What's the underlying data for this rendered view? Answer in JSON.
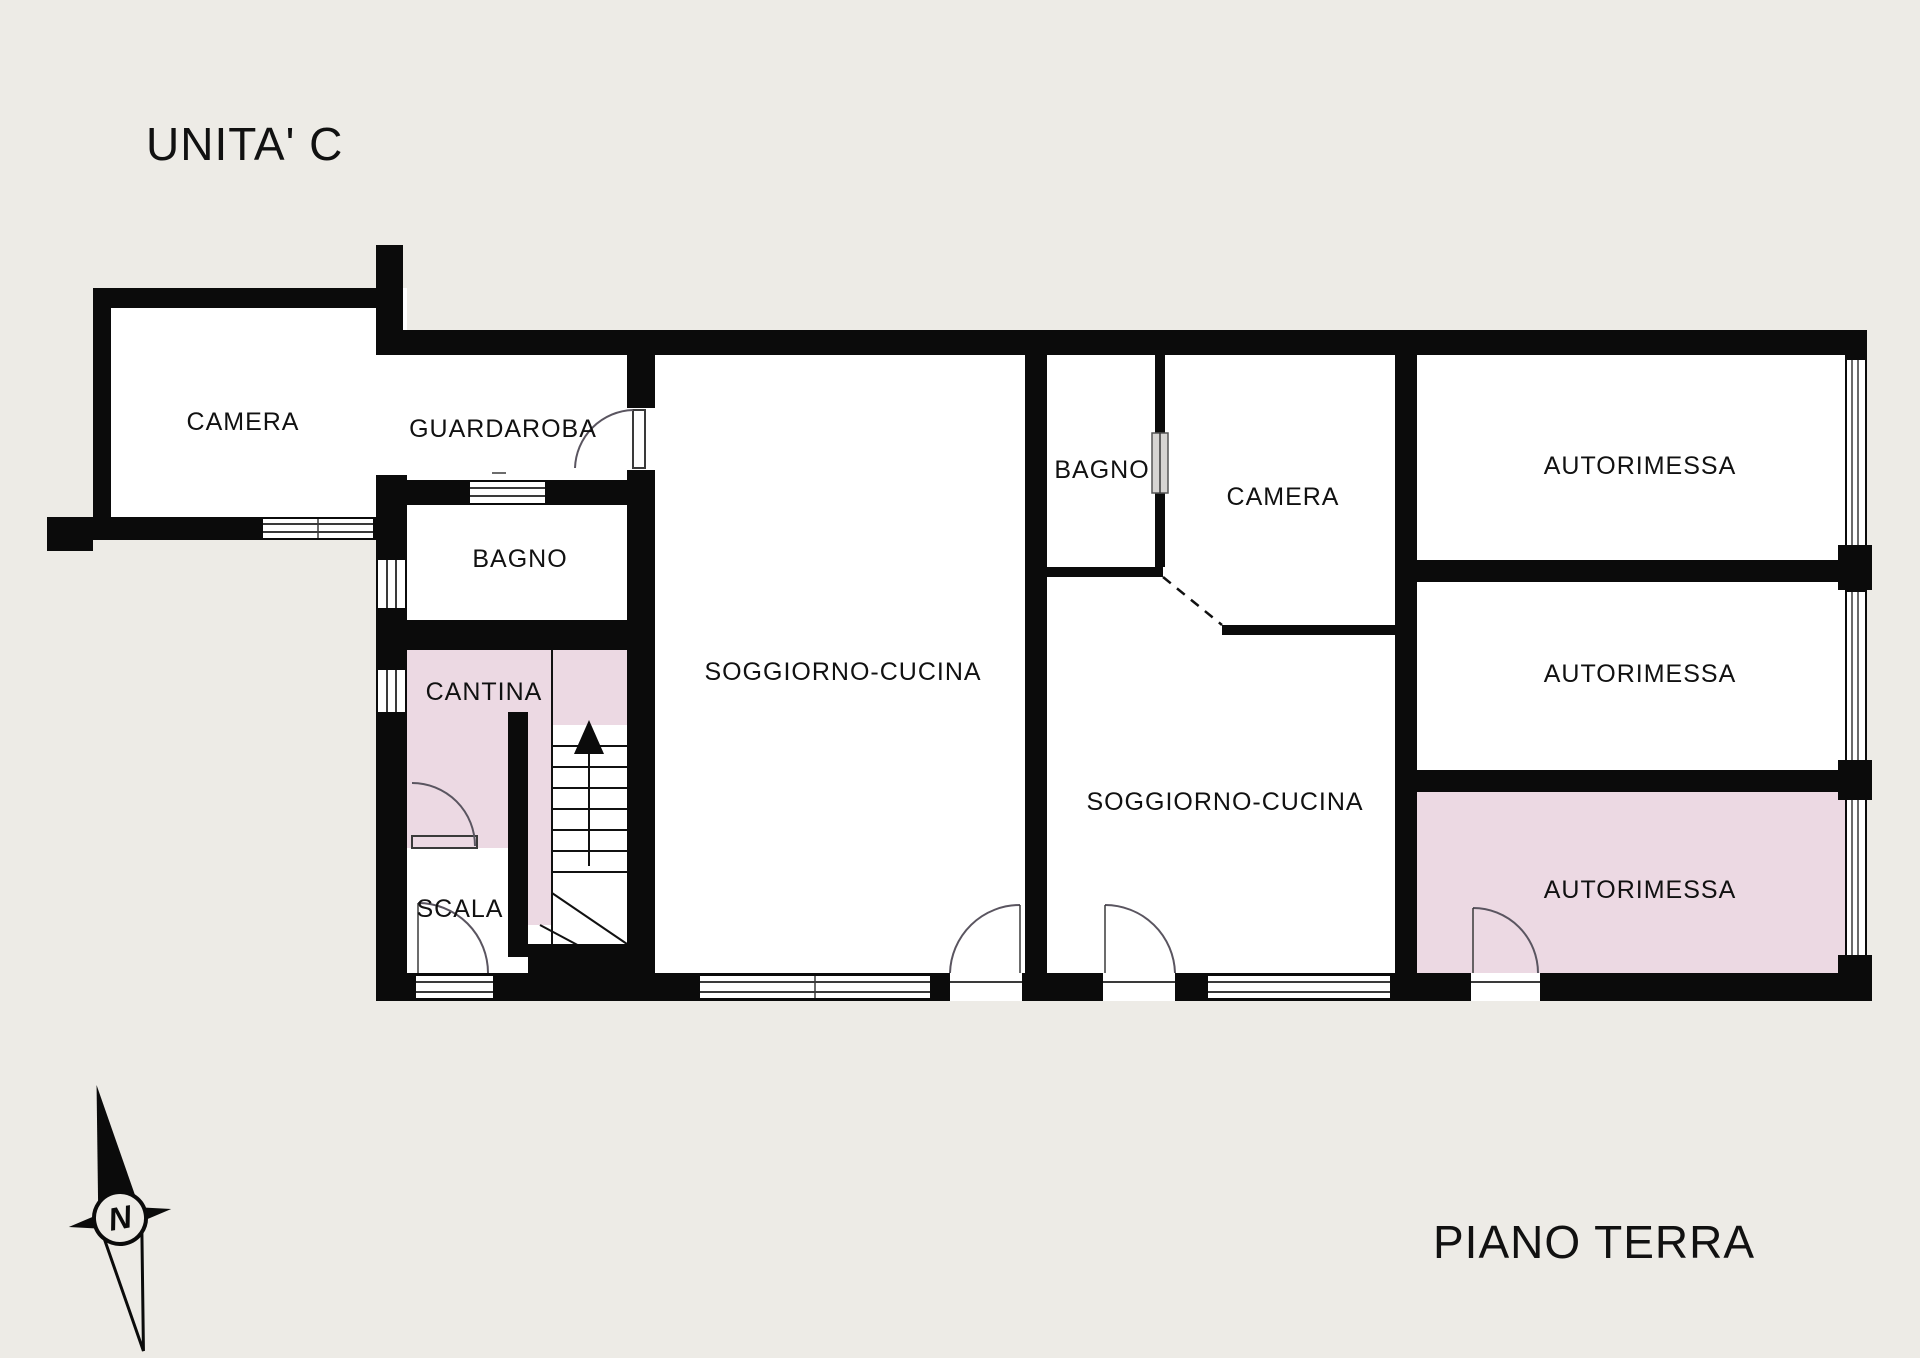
{
  "title": "UNITA' C",
  "floor_label": "PIANO TERRA",
  "compass": {
    "letter": "N"
  },
  "rooms": {
    "camera1": "CAMERA",
    "guardaroba": "GUARDAROBA",
    "bagno1": "BAGNO",
    "cantina": "CANTINA",
    "scala": "SCALA",
    "soggiorno1": "SOGGIORNO-CUCINA",
    "bagno2": "BAGNO",
    "camera2": "CAMERA",
    "soggiorno2": "SOGGIORNO-CUCINA",
    "autorimessa1": "AUTORIMESSA",
    "autorimessa2": "AUTORIMESSA",
    "autorimessa3": "AUTORIMESSA"
  },
  "colors": {
    "background": "#edebe6",
    "wall": "#0b0b0b",
    "room_fill": "#ffffff",
    "highlight_fill": "#ecd9e3"
  }
}
